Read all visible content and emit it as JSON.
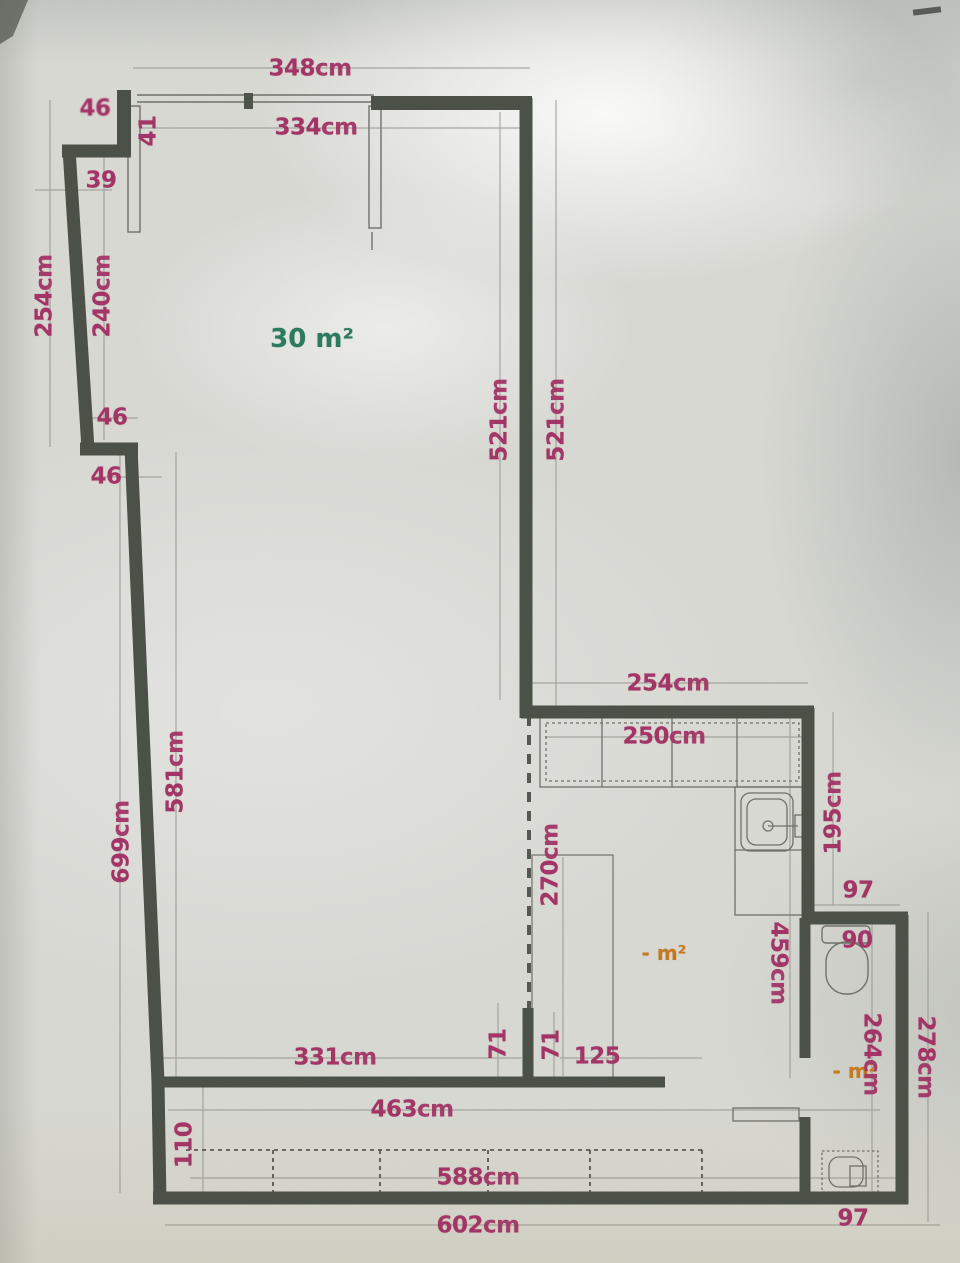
{
  "plan": {
    "rooms": {
      "main": {
        "value": "30",
        "unit": "m²"
      },
      "kitchen": {
        "value": "-",
        "unit": "m²"
      },
      "bathroom": {
        "value": "-",
        "unit": "m²"
      }
    },
    "dimensions": {
      "top_overall": {
        "value": "348",
        "unit": "cm"
      },
      "top_inner": {
        "value": "334",
        "unit": "cm"
      },
      "top_corner_niche": {
        "value": "46",
        "unit": ""
      },
      "window_bay": {
        "value": "41",
        "unit": ""
      },
      "left_upper_offset": {
        "value": "39",
        "unit": ""
      },
      "left_outer_height_upper": {
        "value": "254",
        "unit": "cm"
      },
      "left_inner_height_upper": {
        "value": "240",
        "unit": "cm"
      },
      "left_step_upper": {
        "value": "46",
        "unit": ""
      },
      "left_step_lower": {
        "value": "46",
        "unit": ""
      },
      "main_height_inner": {
        "value": "521",
        "unit": "cm"
      },
      "main_height_outer": {
        "value": "521",
        "unit": "cm"
      },
      "kitchen_width_outer": {
        "value": "254",
        "unit": "cm"
      },
      "kitchen_width_inner": {
        "value": "250",
        "unit": "cm"
      },
      "kitchen_height_right": {
        "value": "195",
        "unit": "cm"
      },
      "kitchen_height_inner": {
        "value": "459",
        "unit": "cm"
      },
      "left_inner_height_lower": {
        "value": "581",
        "unit": "cm"
      },
      "left_outer_height_lower": {
        "value": "699",
        "unit": "cm"
      },
      "table_depth": {
        "value": "270",
        "unit": "cm"
      },
      "bathroom_top_width": {
        "value": "97",
        "unit": ""
      },
      "toilet_width": {
        "value": "90",
        "unit": ""
      },
      "bottom_inner_width": {
        "value": "331",
        "unit": "cm"
      },
      "stub_left_height": {
        "value": "71",
        "unit": ""
      },
      "stub_right_height": {
        "value": "71",
        "unit": ""
      },
      "opening_width": {
        "value": "125",
        "unit": ""
      },
      "bottom_mid_width": {
        "value": "463",
        "unit": "cm"
      },
      "wardrobe_depth": {
        "value": "110",
        "unit": ""
      },
      "wardrobe_width": {
        "value": "588",
        "unit": "cm"
      },
      "bottom_overall_width": {
        "value": "602",
        "unit": "cm"
      },
      "bathroom_height_inner": {
        "value": "264",
        "unit": "cm"
      },
      "bathroom_height_outer": {
        "value": "278",
        "unit": "cm"
      },
      "bathroom_bottom_width": {
        "value": "97",
        "unit": ""
      }
    },
    "fixtures": [
      "kitchen-cabinets",
      "kitchen-sink",
      "dining-table",
      "toilet",
      "washbasin",
      "built-in-wardrobe",
      "window-panes",
      "bathroom-door"
    ],
    "colors": {
      "dimension_text": "#a23566",
      "area_main": "#2c7a60",
      "area_secondary": "#c4781f",
      "wall": "#494e45"
    }
  }
}
